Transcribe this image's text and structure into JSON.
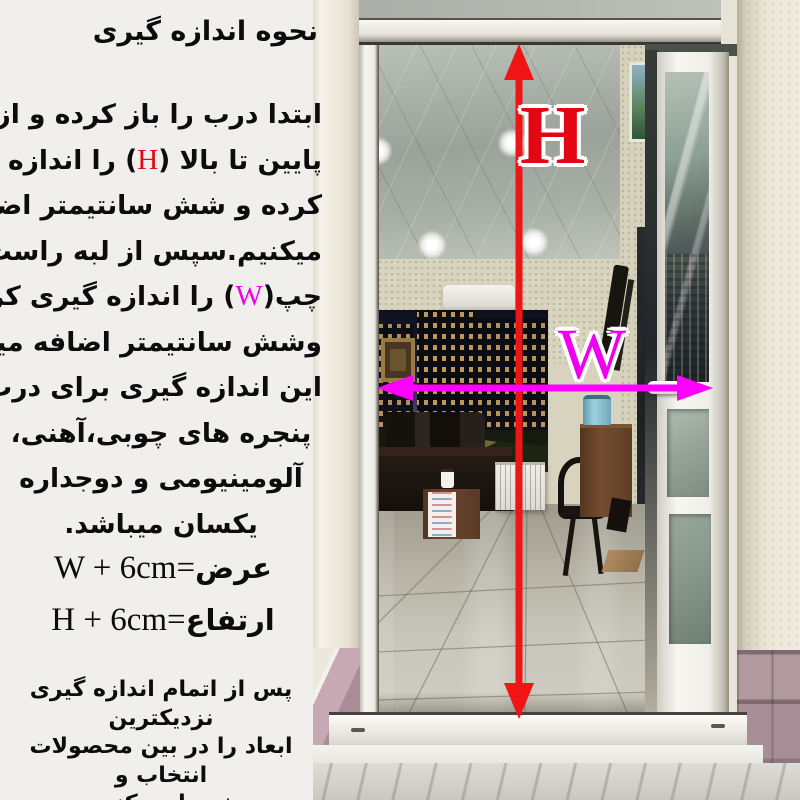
{
  "instructions": {
    "title": "نحوه اندازه گیری",
    "para": [
      {
        "pre": "ابتدا درب را باز کرده و از لبه"
      },
      {
        "pre": "پایین تا بالا (",
        "accent": "H",
        "post": ") را اندازه گیری"
      },
      {
        "pre": "کرده و شش سانتیمتر اضافه"
      },
      {
        "pre": "میکنیم.سپس از لبه راست تا"
      },
      {
        "pre": "چپ(",
        "accent": "W",
        "post": ") را اندازه گیری کرده"
      },
      {
        "pre": "وشش سانتیمتر اضافه میکنیم."
      },
      {
        "pre": "این اندازه گیری برای درب و"
      },
      {
        "pre": "پنجره های چوبی،آهنی،"
      },
      {
        "pre": "آلومینیومی و دوجداره"
      },
      {
        "pre": "یکسان میباشد."
      }
    ],
    "formulas": [
      {
        "label": "عرض",
        "eq": "=",
        "expr": "W + 6cm"
      },
      {
        "label": "ارتفاع",
        "eq": "=",
        "expr": "H + 6cm"
      }
    ],
    "footer_lines": [
      "پس از اتمام اندازه گیری نزدیکترین",
      "ابعاد را در بین محصولات انتخاب و",
      "خریداری کنید."
    ]
  },
  "photo": {
    "height_label": "H",
    "width_label": "W",
    "height_accent_color": "#e30613",
    "width_accent_color": "#ee00ee",
    "height_arrow_color": "#f01414",
    "width_arrow_color": "#ff00ff"
  }
}
